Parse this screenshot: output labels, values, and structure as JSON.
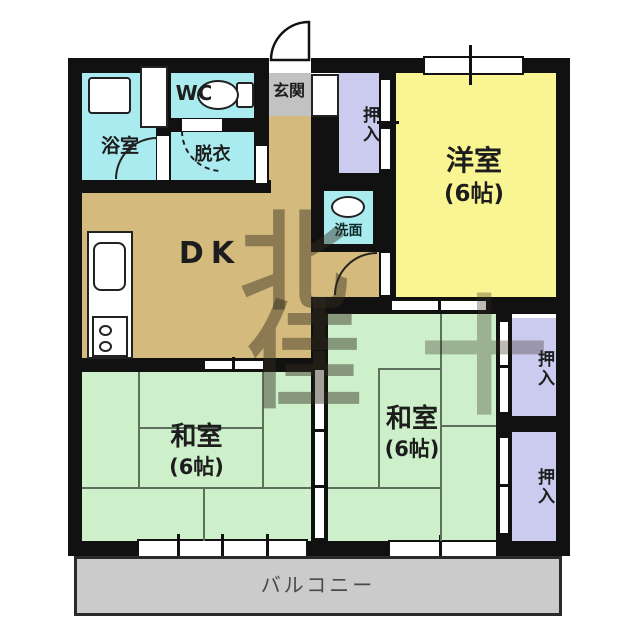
{
  "plan": {
    "rooms": {
      "dk": {
        "label": "DK"
      },
      "western_room": {
        "label": "洋室",
        "size": "(6帖)"
      },
      "japanese_room_left": {
        "label": "和室",
        "size": "(6帖)"
      },
      "japanese_room_right": {
        "label": "和室",
        "size": "(6帖)"
      },
      "bathroom": {
        "label": "浴室"
      },
      "wc": {
        "label": "WC"
      },
      "dressing": {
        "label": "脱衣"
      },
      "entrance": {
        "label": "玄関"
      },
      "washstand": {
        "label": "洗面"
      },
      "closet_top": {
        "label": "押入"
      },
      "closet_right_top": {
        "label": "押入"
      },
      "closet_right_bottom": {
        "label": "押入"
      },
      "balcony": {
        "label": "バルコニー"
      }
    },
    "watermark": {
      "glyphs": [
        "北",
        "佳",
        "十"
      ]
    },
    "colors": {
      "wall": "#111111",
      "dk_floor": "#D4BA7D",
      "western_room_floor": "#FAF593",
      "japanese_room_floor": "#CDEFC9",
      "closet_floor": "#CBCBEF",
      "wet_area_floor": "#A9EBEE",
      "entrance_floor": "#C2C2C2",
      "balcony_floor": "#CBCBCB",
      "tatami_line": "#5E6F5E"
    }
  }
}
